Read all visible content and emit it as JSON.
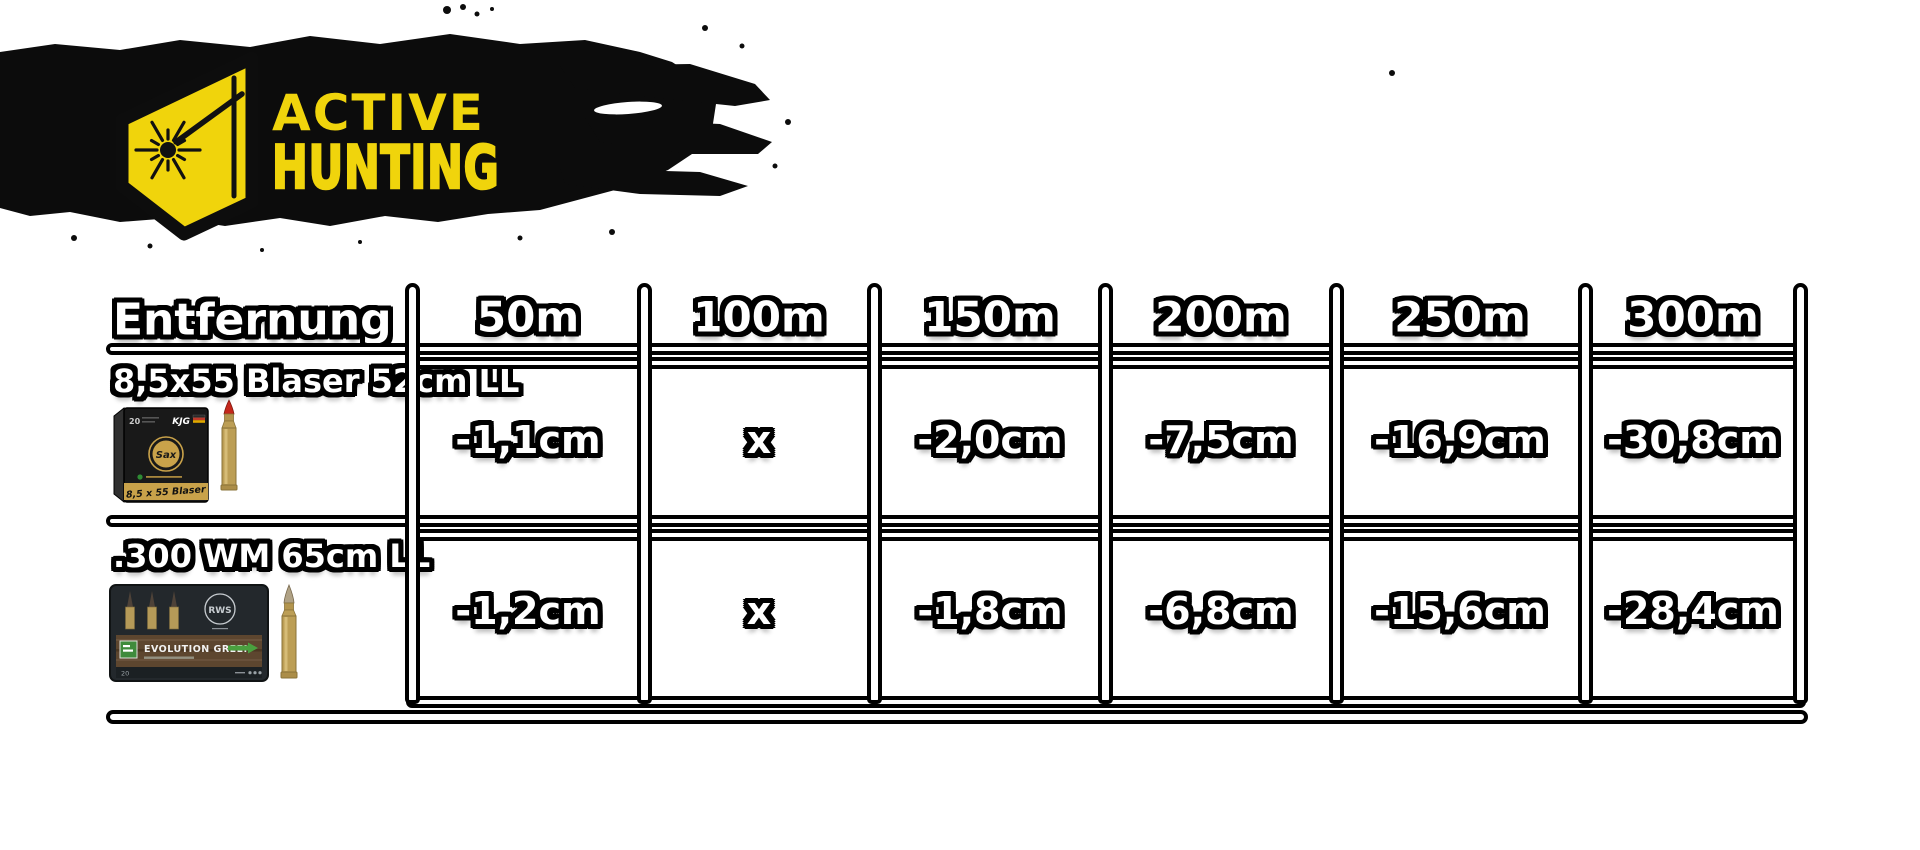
{
  "logo": {
    "line1": "ACTIVE",
    "line2": "HUNTING"
  },
  "colors": {
    "accent": "#F0D40C",
    "ink": "#0d0d0d",
    "paper": "#ffffff",
    "brass": "#bc9e55",
    "gold_band": "#c9a24a",
    "red_tip": "#c4271b",
    "wood": "#5d462f",
    "evo_green": "#3f8b3c",
    "box_dark": "#23282c"
  },
  "table": {
    "header": {
      "label": "Entfernung",
      "columns": [
        "50m",
        "100m",
        "150m",
        "200m",
        "250m",
        "300m"
      ]
    },
    "rows": [
      {
        "label": "8,5x55 Blaser 52cm LL",
        "values": [
          "-1,1cm",
          "x",
          "-2,0cm",
          "-7,5cm",
          "-16,9cm",
          "-30,8cm"
        ],
        "box": {
          "count": "20",
          "type": "KJG",
          "brand": "Sax",
          "caliber": "8,5 x 55 Blaser"
        }
      },
      {
        "label": ".300 WM 65cm LL",
        "values": [
          "-1,2cm",
          "x",
          "-1,8cm",
          "-6,8cm",
          "-15,6cm",
          "-28,4cm"
        ],
        "box": {
          "brand": "RWS",
          "product": "EVOLUTION GREEN",
          "count": "20"
        }
      }
    ]
  },
  "chart_data": {
    "type": "table",
    "title": "Ballistic drop table (Active Hunting)",
    "columns": [
      "Entfernung",
      "50m",
      "100m",
      "150m",
      "200m",
      "250m",
      "300m"
    ],
    "rows": [
      [
        "8,5x55 Blaser 52cm LL",
        "-1,1cm",
        "x",
        "-2,0cm",
        "-7,5cm",
        "-16,9cm",
        "-30,8cm"
      ],
      [
        ".300 WM 65cm LL",
        "-1,2cm",
        "x",
        "-1,8cm",
        "-6,8cm",
        "-15,6cm",
        "-28,4cm"
      ]
    ],
    "x_distances_m": [
      50,
      100,
      150,
      200,
      250,
      300
    ],
    "series": [
      {
        "name": "8,5x55 Blaser 52cm LL",
        "drop_cm": [
          -1.1,
          0,
          -2.0,
          -7.5,
          -16.9,
          -30.8
        ],
        "zero_note": "x = zeroed at 100m"
      },
      {
        "name": ".300 WM 65cm LL",
        "drop_cm": [
          -1.2,
          0,
          -1.8,
          -6.8,
          -15.6,
          -28.4
        ],
        "zero_note": "x = zeroed at 100m"
      }
    ]
  }
}
